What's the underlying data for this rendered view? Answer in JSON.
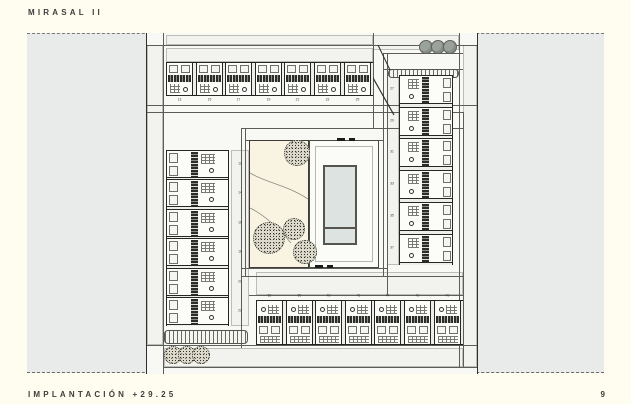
{
  "header": {
    "title": "MIRASAL II"
  },
  "footer": {
    "label": "IMPLANTACIÓN +29.25",
    "page_number": "9"
  },
  "plan": {
    "drawing_name": "site-plan-implantation",
    "unit_numbers": {
      "top_row": [
        "13",
        "15",
        "17",
        "19",
        "21",
        "23",
        "25"
      ],
      "bottom_row": [
        "52",
        "50",
        "48",
        "46",
        "44",
        "42",
        "40"
      ],
      "left_column": [
        "12",
        "14",
        "16",
        "18",
        "20",
        "22"
      ],
      "right_column": [
        "27",
        "29",
        "31",
        "33",
        "35",
        "37"
      ]
    },
    "features": {
      "pool_label": "swimming-pool",
      "garden_tree_count": 4,
      "street_tree_count_top_right": 3,
      "street_tree_count_bottom_left": 3
    },
    "colors": {
      "paper": "#fffdf0",
      "canvas_grey": "#e9eaea",
      "water": "#dde3e1",
      "garden": "#f9f4e1",
      "ink": "#2b2b2b"
    }
  }
}
